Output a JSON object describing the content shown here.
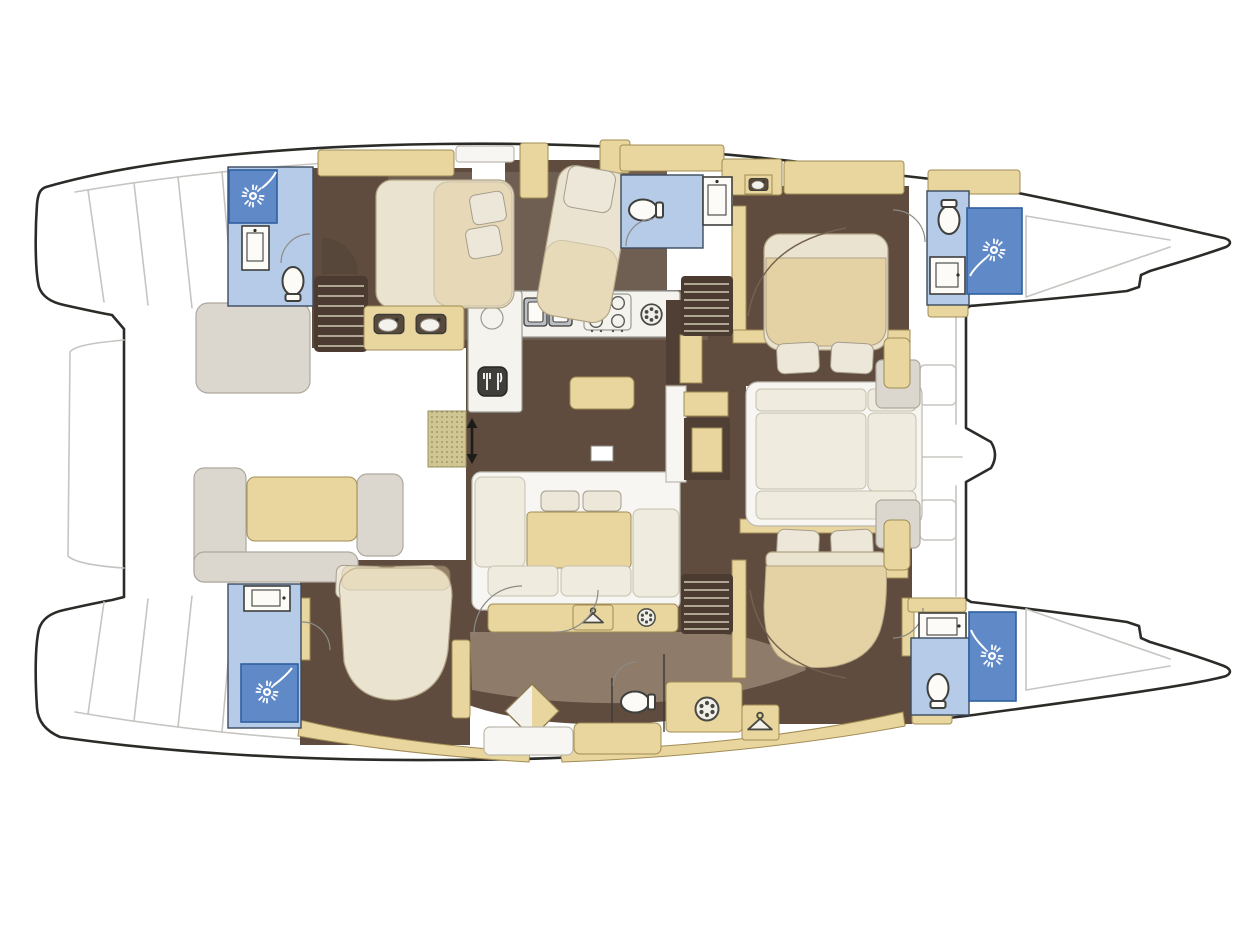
{
  "page": {
    "background": "#ffffff",
    "subject": "Top-down interior layout floor plan of a sailing catamaran"
  },
  "palette": {
    "outline": "#2b2b28",
    "faint": "#c7c5c1",
    "tan": "#e9d69e",
    "tanBorder": "#a08c54",
    "cream": "#efecdf",
    "creamBorder": "#c6c0ae",
    "benchGray": "#dbd6ce",
    "benchBorder": "#aea89d",
    "bedSheet": "#eae3d0",
    "bedTan": "#e5d2a4",
    "bedBorder": "#b1a283",
    "pillow": "#ece7d8",
    "pillowBorder": "#a59d8d",
    "floorDark": "#5f4c3f",
    "floorMid": "#8e7b69",
    "floorDeep": "#4b3b31",
    "stepLine": "#d2c9b6",
    "bathFloor": "#b6cbe8",
    "showerFill": "#6089c7",
    "showerBorder": "#2f5f9e",
    "fixtureWhite": "#fcfbf8",
    "fixtureBorder": "#3f3f3c",
    "counterWhite": "#f4f3ee",
    "counterBorder": "#9b9b95",
    "appliance": "#bcc0c4",
    "matFill": "#cfc694",
    "matBorder": "#98915f",
    "matDot": "#8f8a5e",
    "darkCabinet": "#4f3f35",
    "arcGray": "#8b8b86"
  },
  "diagram": {
    "type": "floor-plan",
    "vessel": "catamaran",
    "orientation": {
      "bow": "right",
      "stern": "left",
      "port_hull": "top",
      "starboard_hull": "bottom"
    },
    "areas": [
      {
        "id": "aft-cockpit",
        "hull": "bridge-deck",
        "position": "aft"
      },
      {
        "id": "salon",
        "hull": "bridge-deck",
        "position": "center"
      },
      {
        "id": "galley",
        "hull": "bridge-deck",
        "position": "center-forward"
      },
      {
        "id": "forward-lounge",
        "hull": "bridge-deck",
        "position": "forward"
      },
      {
        "id": "forward-cockpit",
        "hull": "bridge-deck",
        "position": "forward"
      },
      {
        "id": "bathroom-port-aft",
        "hull": "port",
        "position": "aft"
      },
      {
        "id": "cabin-port-aft",
        "hull": "port",
        "position": "aft"
      },
      {
        "id": "cabin-port-mid",
        "hull": "port",
        "position": "mid"
      },
      {
        "id": "bathroom-port-mid",
        "hull": "port",
        "position": "mid"
      },
      {
        "id": "cabin-port-forward",
        "hull": "port",
        "position": "forward"
      },
      {
        "id": "bathroom-port-forward",
        "hull": "port",
        "position": "forward"
      },
      {
        "id": "bathroom-starboard-aft",
        "hull": "starboard",
        "position": "aft"
      },
      {
        "id": "cabin-starboard-aft",
        "hull": "starboard",
        "position": "aft"
      },
      {
        "id": "utility-area-starboard",
        "hull": "starboard",
        "position": "mid"
      },
      {
        "id": "cabin-starboard-forward",
        "hull": "starboard",
        "position": "forward"
      },
      {
        "id": "bathroom-starboard-forward",
        "hull": "starboard",
        "position": "forward"
      },
      {
        "id": "swim-platform-port",
        "hull": "port",
        "position": "stern"
      },
      {
        "id": "swim-platform-starboard",
        "hull": "starboard",
        "position": "stern"
      },
      {
        "id": "anchor-locker-port",
        "hull": "port",
        "position": "bow"
      },
      {
        "id": "anchor-locker-starboard",
        "hull": "starboard",
        "position": "bow"
      },
      {
        "id": "bowsprit",
        "hull": "bridge-deck",
        "position": "bow"
      }
    ],
    "fixtures": {
      "double_beds": 5,
      "shower_stalls": 4,
      "toilets": 5,
      "washbasins": 8,
      "staircases": 3,
      "dining_tables": 2,
      "salon_sofa": 1,
      "cockpit_benches": 2,
      "washing_machine": 1,
      "wardrobe_hangers": 2
    },
    "icons": [
      {
        "name": "shower-head-icon",
        "count": 4
      },
      {
        "name": "toilet-icon",
        "count": 5
      },
      {
        "name": "washbasin-icon",
        "count": 8
      },
      {
        "name": "stove-burners-icon",
        "count": 1
      },
      {
        "name": "double-sink-icon",
        "count": 1
      },
      {
        "name": "round-sink-icon",
        "count": 1
      },
      {
        "name": "cutlery-icon",
        "count": 1
      },
      {
        "name": "coat-hanger-icon",
        "count": 2
      },
      {
        "name": "washing-machine-icon",
        "count": 1
      },
      {
        "name": "porthole-vent-icon",
        "count": 2
      },
      {
        "name": "stairs-icon",
        "count": 3
      },
      {
        "name": "companionway-arrows-icon",
        "count": 1
      }
    ]
  }
}
